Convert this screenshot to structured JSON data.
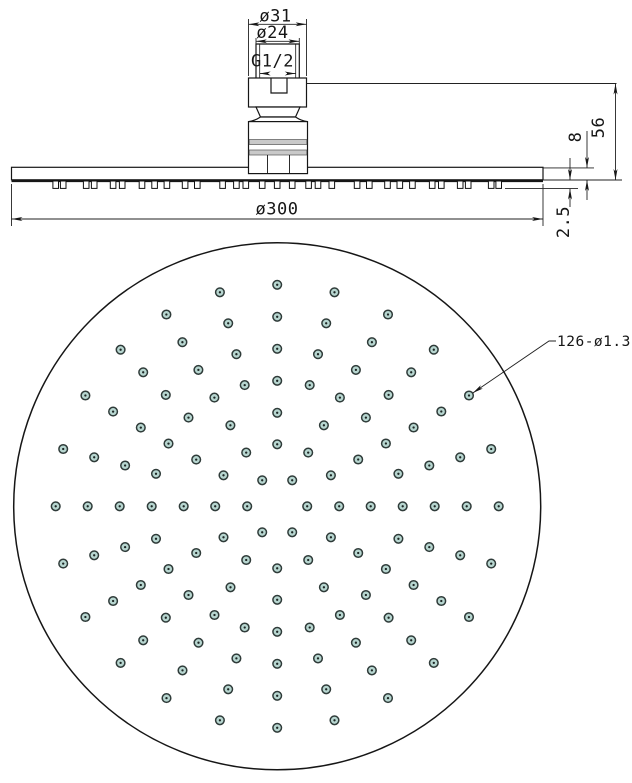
{
  "drawing": {
    "type": "technical-drawing",
    "subject": "round rain shower head",
    "views": [
      "side-elevation",
      "face-view"
    ]
  },
  "side_view": {
    "dimensions": {
      "top_outer_diameter": "ø31",
      "neck_diameter": "ø24",
      "thread": "G1/2",
      "overall_height": "56",
      "head_thickness": "8",
      "face_diameter": "ø300",
      "nozzle_protrusion": "2.5"
    }
  },
  "face_view": {
    "holes_callout": "126-ø1.3",
    "hole_count": 126,
    "hole_diameter_mm": 1.3,
    "face_diameter_mm": 300,
    "center_px": [
      277.2,
      506.3
    ],
    "radius_px": 263.5,
    "rings": [
      {
        "radius_px": 30.0,
        "count": 6,
        "start_deg": 0
      },
      {
        "radius_px": 62.0,
        "count": 12,
        "start_deg": 0
      },
      {
        "radius_px": 93.5,
        "count": 12,
        "start_deg": 0
      },
      {
        "radius_px": 125.5,
        "count": 24,
        "start_deg": 0
      },
      {
        "radius_px": 157.5,
        "count": 24,
        "start_deg": 0
      },
      {
        "radius_px": 189.5,
        "count": 24,
        "start_deg": 0
      },
      {
        "radius_px": 221.5,
        "count": 24,
        "start_deg": 0
      }
    ],
    "leader_target_ring": 6,
    "leader_target_deg": -30
  },
  "colors": {
    "line": "#161616",
    "dim_line": "#222222",
    "hole_fill": "#b7d6d0",
    "hole_ring": "#2f3b39",
    "hole_dot": "#1c2624",
    "band_gray": "#c9c9c9",
    "background": "#ffffff"
  }
}
